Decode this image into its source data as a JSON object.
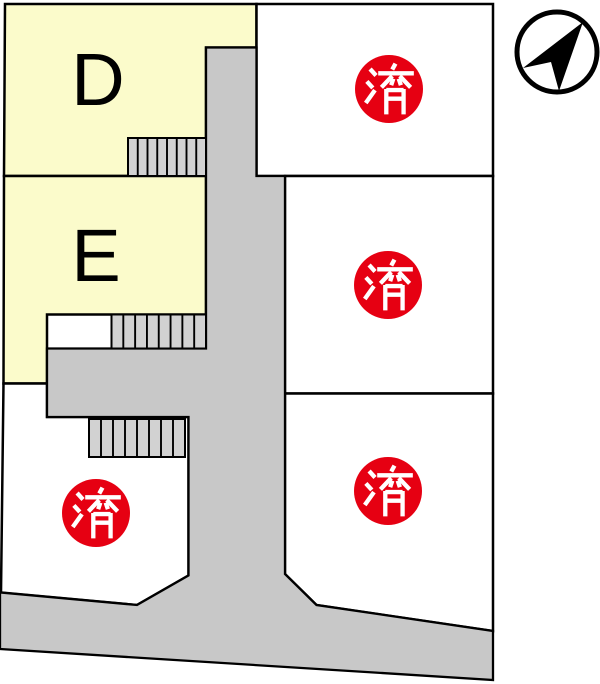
{
  "map": {
    "plots": [
      {
        "id": "plot-d",
        "label": "D"
      },
      {
        "id": "plot-e",
        "label": "E"
      },
      {
        "id": "plot-top-right",
        "badge": "済"
      },
      {
        "id": "plot-middle-right",
        "badge": "済"
      },
      {
        "id": "plot-bottom-left",
        "badge": "済"
      },
      {
        "id": "plot-bottom-right",
        "badge": "済"
      }
    ],
    "colors": {
      "plot_available_fill": "#fbfbcb",
      "plot_sold_fill": "#ffffff",
      "road_fill": "#c8c8c8",
      "stairs_fill": "#d2d2d2",
      "outline": "#000000",
      "sold_badge_fill": "#e60012",
      "sold_badge_text": "#ffffff",
      "background": "#ffffff"
    },
    "icons": {
      "compass": "north-arrow-icon"
    }
  }
}
